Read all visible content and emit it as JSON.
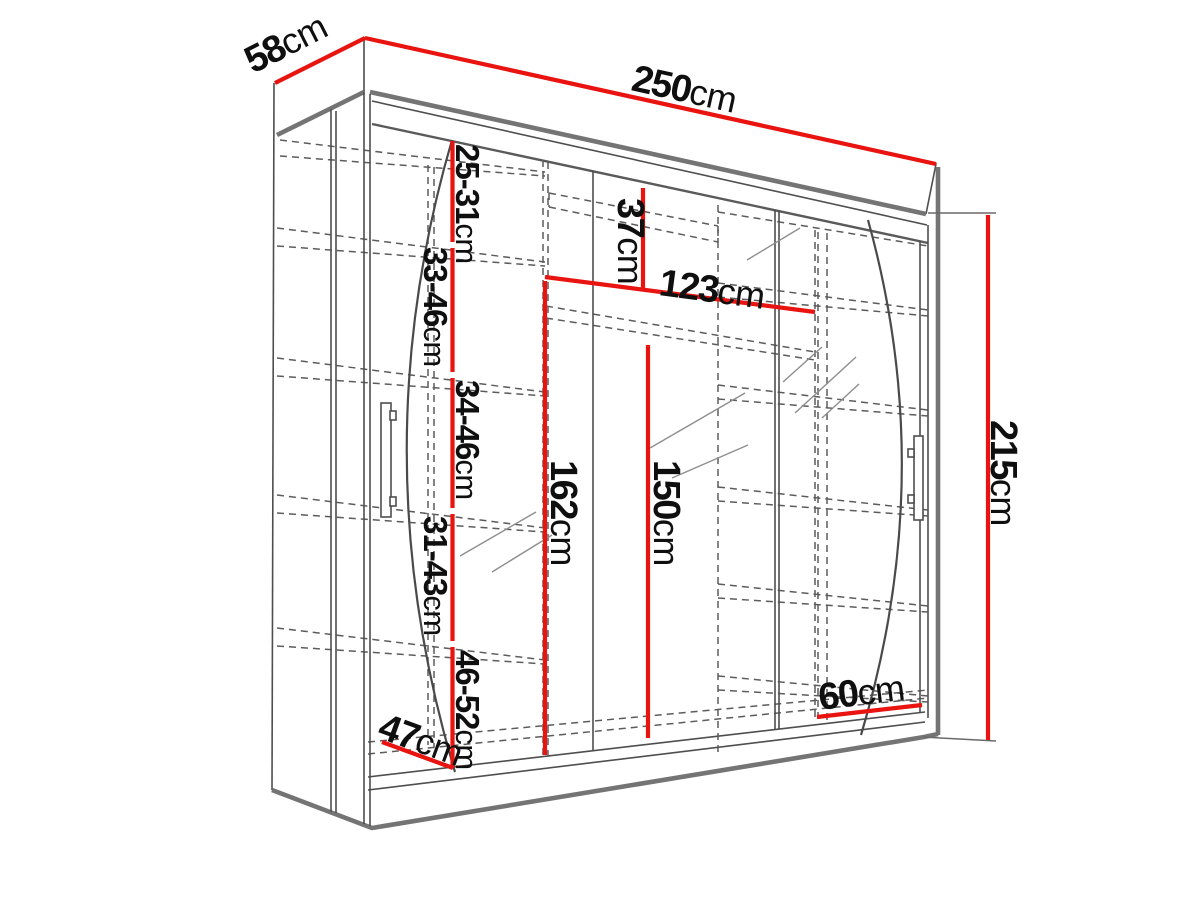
{
  "diagram": {
    "colors": {
      "background": "#ffffff",
      "dimension_line_red": "#e9130f",
      "outline_gray": "#4e4e4e",
      "hidden_line_gray": "#5c5c5c",
      "label_text": "#0f0f0f"
    },
    "dims": {
      "width": {
        "v": "250",
        "u": "cm"
      },
      "depth": {
        "v": "58",
        "u": "cm"
      },
      "height": {
        "v": "215",
        "u": "cm"
      },
      "inner_width": {
        "v": "123",
        "u": "cm"
      },
      "top_niche": {
        "v": "37",
        "u": "cm"
      },
      "hang_left": {
        "v": "162",
        "u": "cm"
      },
      "hang_right": {
        "v": "150",
        "u": "cm"
      },
      "gap_1": {
        "v": "25-31",
        "u": "cm"
      },
      "gap_2": {
        "v": "33-46",
        "u": "cm"
      },
      "gap_3": {
        "v": "34-46",
        "u": "cm"
      },
      "gap_4": {
        "v": "31-43",
        "u": "cm"
      },
      "gap_5": {
        "v": "46-52",
        "u": "cm"
      },
      "bottom_width": {
        "v": "60",
        "u": "cm"
      },
      "bottom_depth": {
        "v": "47",
        "u": "cm"
      }
    }
  }
}
